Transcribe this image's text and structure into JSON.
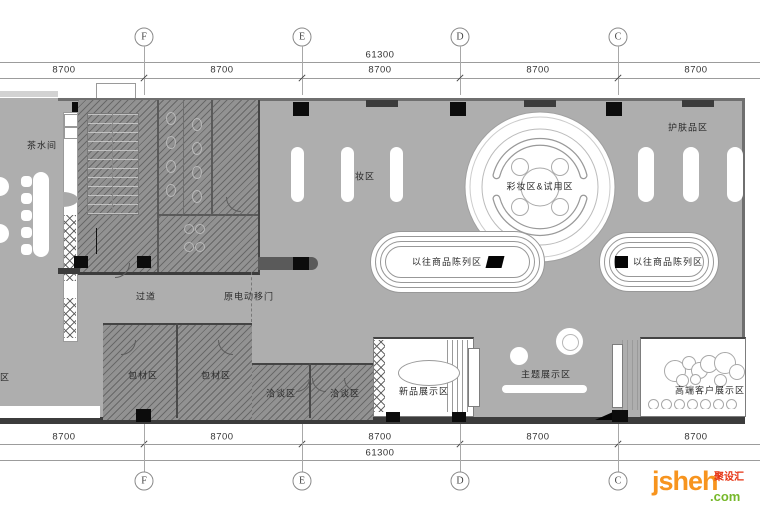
{
  "grid": {
    "letters": [
      "F",
      "E",
      "D",
      "C"
    ],
    "total_dim": "61300",
    "segment_dim": "8700"
  },
  "labels": {
    "tea_room": "茶水间",
    "makeup": "彩妆区",
    "skincare": "护肤品区",
    "makeup_trial": "彩妆区&试用区",
    "prev_display": "以往商品陈列区",
    "corridor": "过道",
    "sliding_door": "原电动移门",
    "packing": "包材区",
    "meeting": "洽谈区",
    "new_product": "新品展示区",
    "theme_display": "主题展示区",
    "vip_display": "高端客户展示区",
    "edge_partial": "区"
  },
  "logo": {
    "brand": "jsheh",
    "tld": ".com",
    "cn": "聚设汇"
  },
  "colors": {
    "floor": "#aeaeae",
    "hatch_room": "#929292",
    "wall": "#3c3c3c",
    "logo_orange": "#f7941e",
    "logo_green": "#76b82a",
    "logo_red": "#e63312"
  }
}
